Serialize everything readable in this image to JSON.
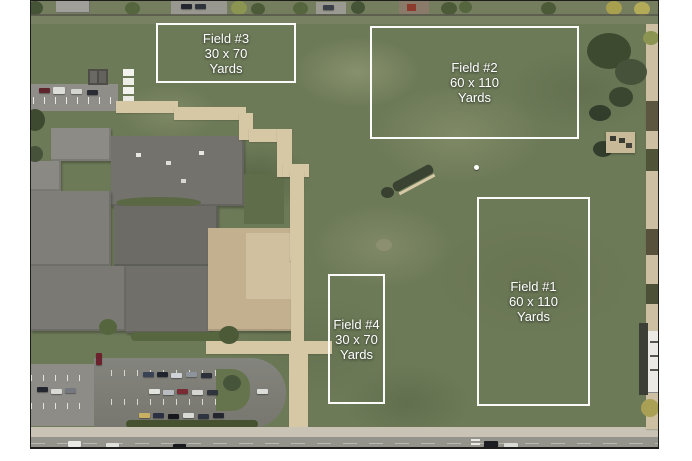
{
  "map": {
    "description": "aerial-photo-of-school-campus-with-field-annotations",
    "annotation_color": "#ffffff",
    "fields": [
      {
        "id": "field-1",
        "title": "Field #1",
        "size": "60 x 110",
        "unit": "Yards",
        "box": {
          "x": 446,
          "y": 196,
          "w": 113,
          "h": 209
        }
      },
      {
        "id": "field-2",
        "title": "Field #2",
        "size": "60 x 110",
        "unit": "Yards",
        "box": {
          "x": 339,
          "y": 25,
          "w": 209,
          "h": 113
        }
      },
      {
        "id": "field-3",
        "title": "Field #3",
        "size": "30 x 70",
        "unit": "Yards",
        "box": {
          "x": 125,
          "y": 22,
          "w": 140,
          "h": 60
        }
      },
      {
        "id": "field-4",
        "title": "Field #4",
        "size": "30 x 70",
        "unit": "Yards",
        "box": {
          "x": 297,
          "y": 273,
          "w": 57,
          "h": 130
        }
      }
    ]
  }
}
